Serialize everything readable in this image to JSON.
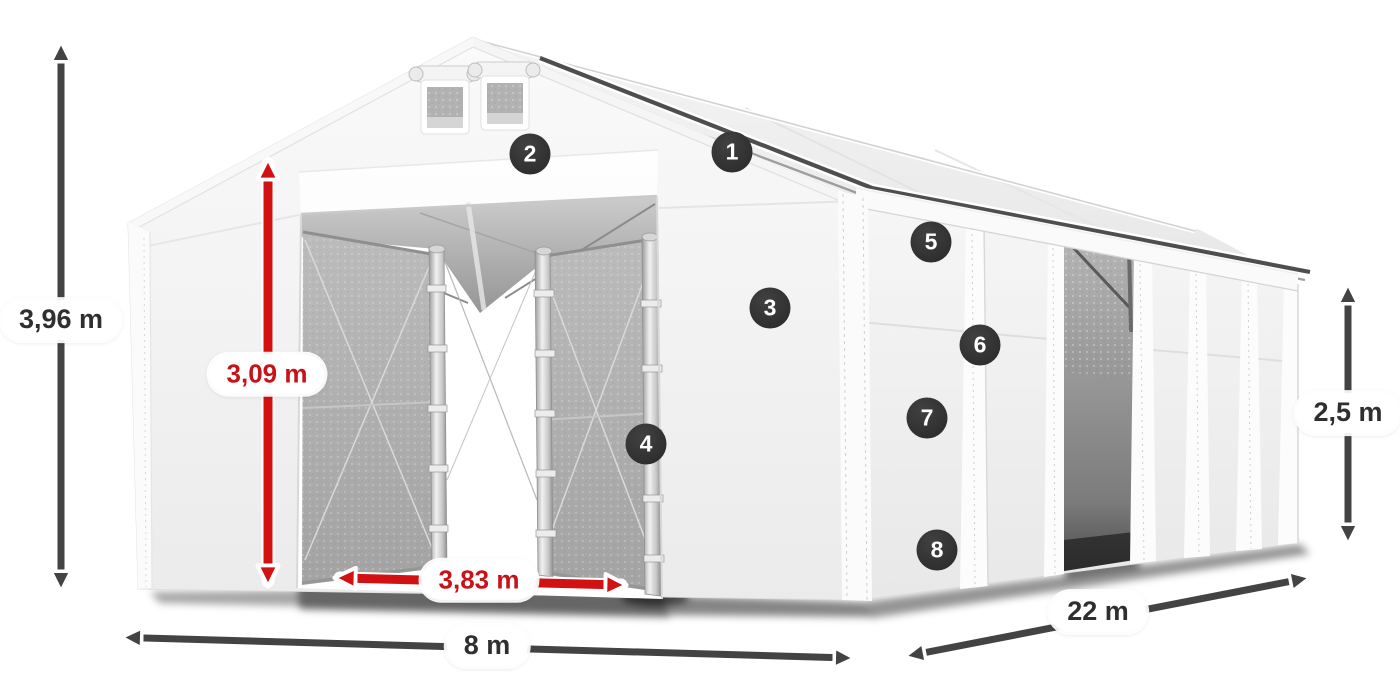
{
  "diagram": {
    "description": "White storage tent shown in perspective with open front entrance, mesh sliding door panels, side wall with open side door, dimension arrows and numbered feature markers",
    "dimensions": [
      {
        "id": "total-height",
        "label": "3,96 m",
        "color": "dark"
      },
      {
        "id": "entrance-height",
        "label": "3,09 m",
        "color": "red"
      },
      {
        "id": "entrance-width",
        "label": "3,83 m",
        "color": "red"
      },
      {
        "id": "gable-width",
        "label": "8 m",
        "color": "dark"
      },
      {
        "id": "side-length",
        "label": "22 m",
        "color": "dark"
      },
      {
        "id": "side-height",
        "label": "2,5 m",
        "color": "dark"
      }
    ],
    "markers": [
      {
        "number": "1"
      },
      {
        "number": "2"
      },
      {
        "number": "3"
      },
      {
        "number": "4"
      },
      {
        "number": "5"
      },
      {
        "number": "6"
      },
      {
        "number": "7"
      },
      {
        "number": "8"
      }
    ],
    "colors": {
      "arrow_dark": "#434343",
      "arrow_red": "#d11112",
      "marker_bg": "#2f2f2f",
      "marker_text": "#ffffff",
      "label_bg": "#ffffff",
      "label_text_dark": "#2f2f2f",
      "label_text_red": "#c8121a"
    }
  }
}
